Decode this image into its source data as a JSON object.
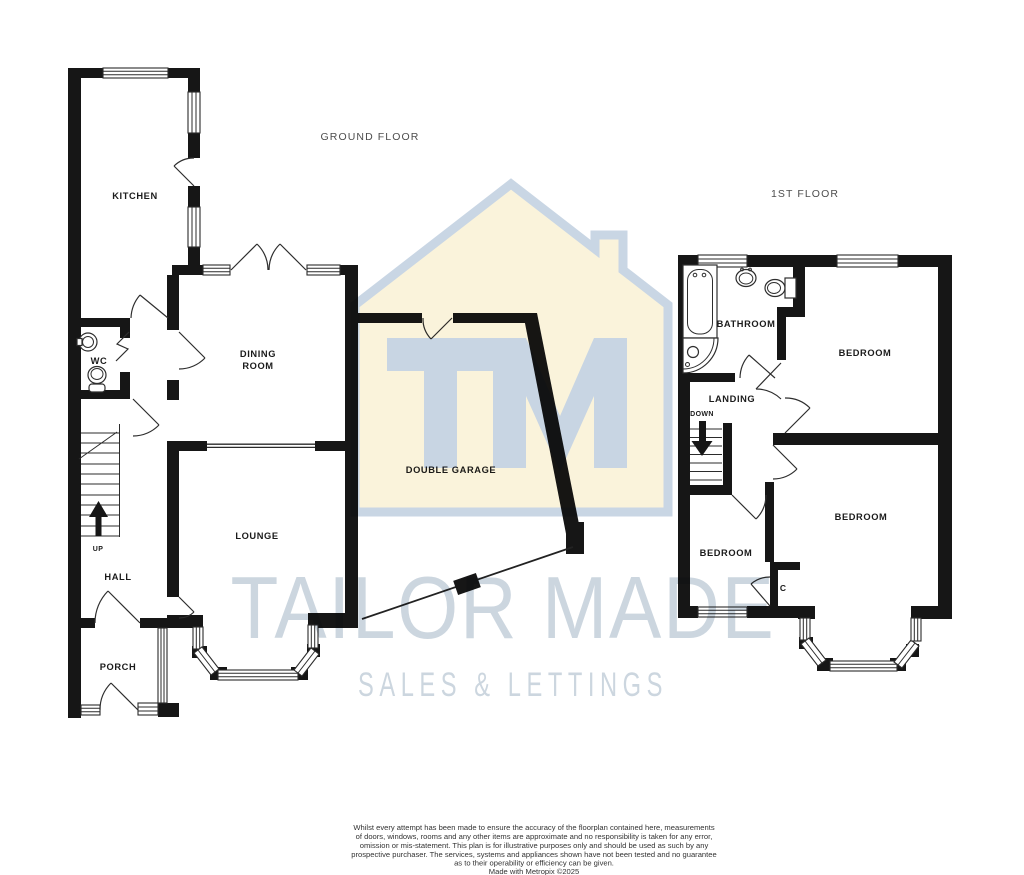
{
  "watermark": {
    "logo_text": "TM",
    "brand_line1": "TAILOR MADE",
    "brand_line2": "SALES & LETTINGS",
    "house_fill": "#FAF3DB",
    "outline_color": "#C9D6E4",
    "logo_color": "#C8D5E3",
    "text_color": "#CCD6DF"
  },
  "colors": {
    "wall": "#161616",
    "label": "#1b1b1b",
    "floor_title": "#4d4d4d",
    "disclaimer": "#333333"
  },
  "floors": {
    "ground": {
      "title": "GROUND FLOOR",
      "stairs_label": "UP",
      "rooms": {
        "kitchen": "KITCHEN",
        "wc": "WC",
        "dining_line1": "DINING",
        "dining_line2": "ROOM",
        "lounge": "LOUNGE",
        "hall": "HALL",
        "porch": "PORCH",
        "garage": "DOUBLE GARAGE"
      }
    },
    "first": {
      "title": "1ST FLOOR",
      "stairs_label": "DOWN",
      "rooms": {
        "bathroom": "BATHROOM",
        "landing": "LANDING",
        "bedroom_rear": "BEDROOM",
        "bedroom_front": "BEDROOM",
        "bedroom_small": "BEDROOM",
        "cupboard": "C"
      }
    }
  },
  "disclaimer": {
    "lines": [
      "Whilst every attempt has been made to ensure the accuracy of the floorplan contained here, measurements",
      "of doors, windows, rooms and any other items are approximate and no responsibility is taken for any error,",
      "omission or mis-statement. This plan is for illustrative purposes only and should be used as such by any",
      "prospective purchaser. The services, systems and appliances shown have not been tested and no guarantee",
      "as to their operability or efficiency can be given.",
      "Made with Metropix ©2025"
    ]
  }
}
